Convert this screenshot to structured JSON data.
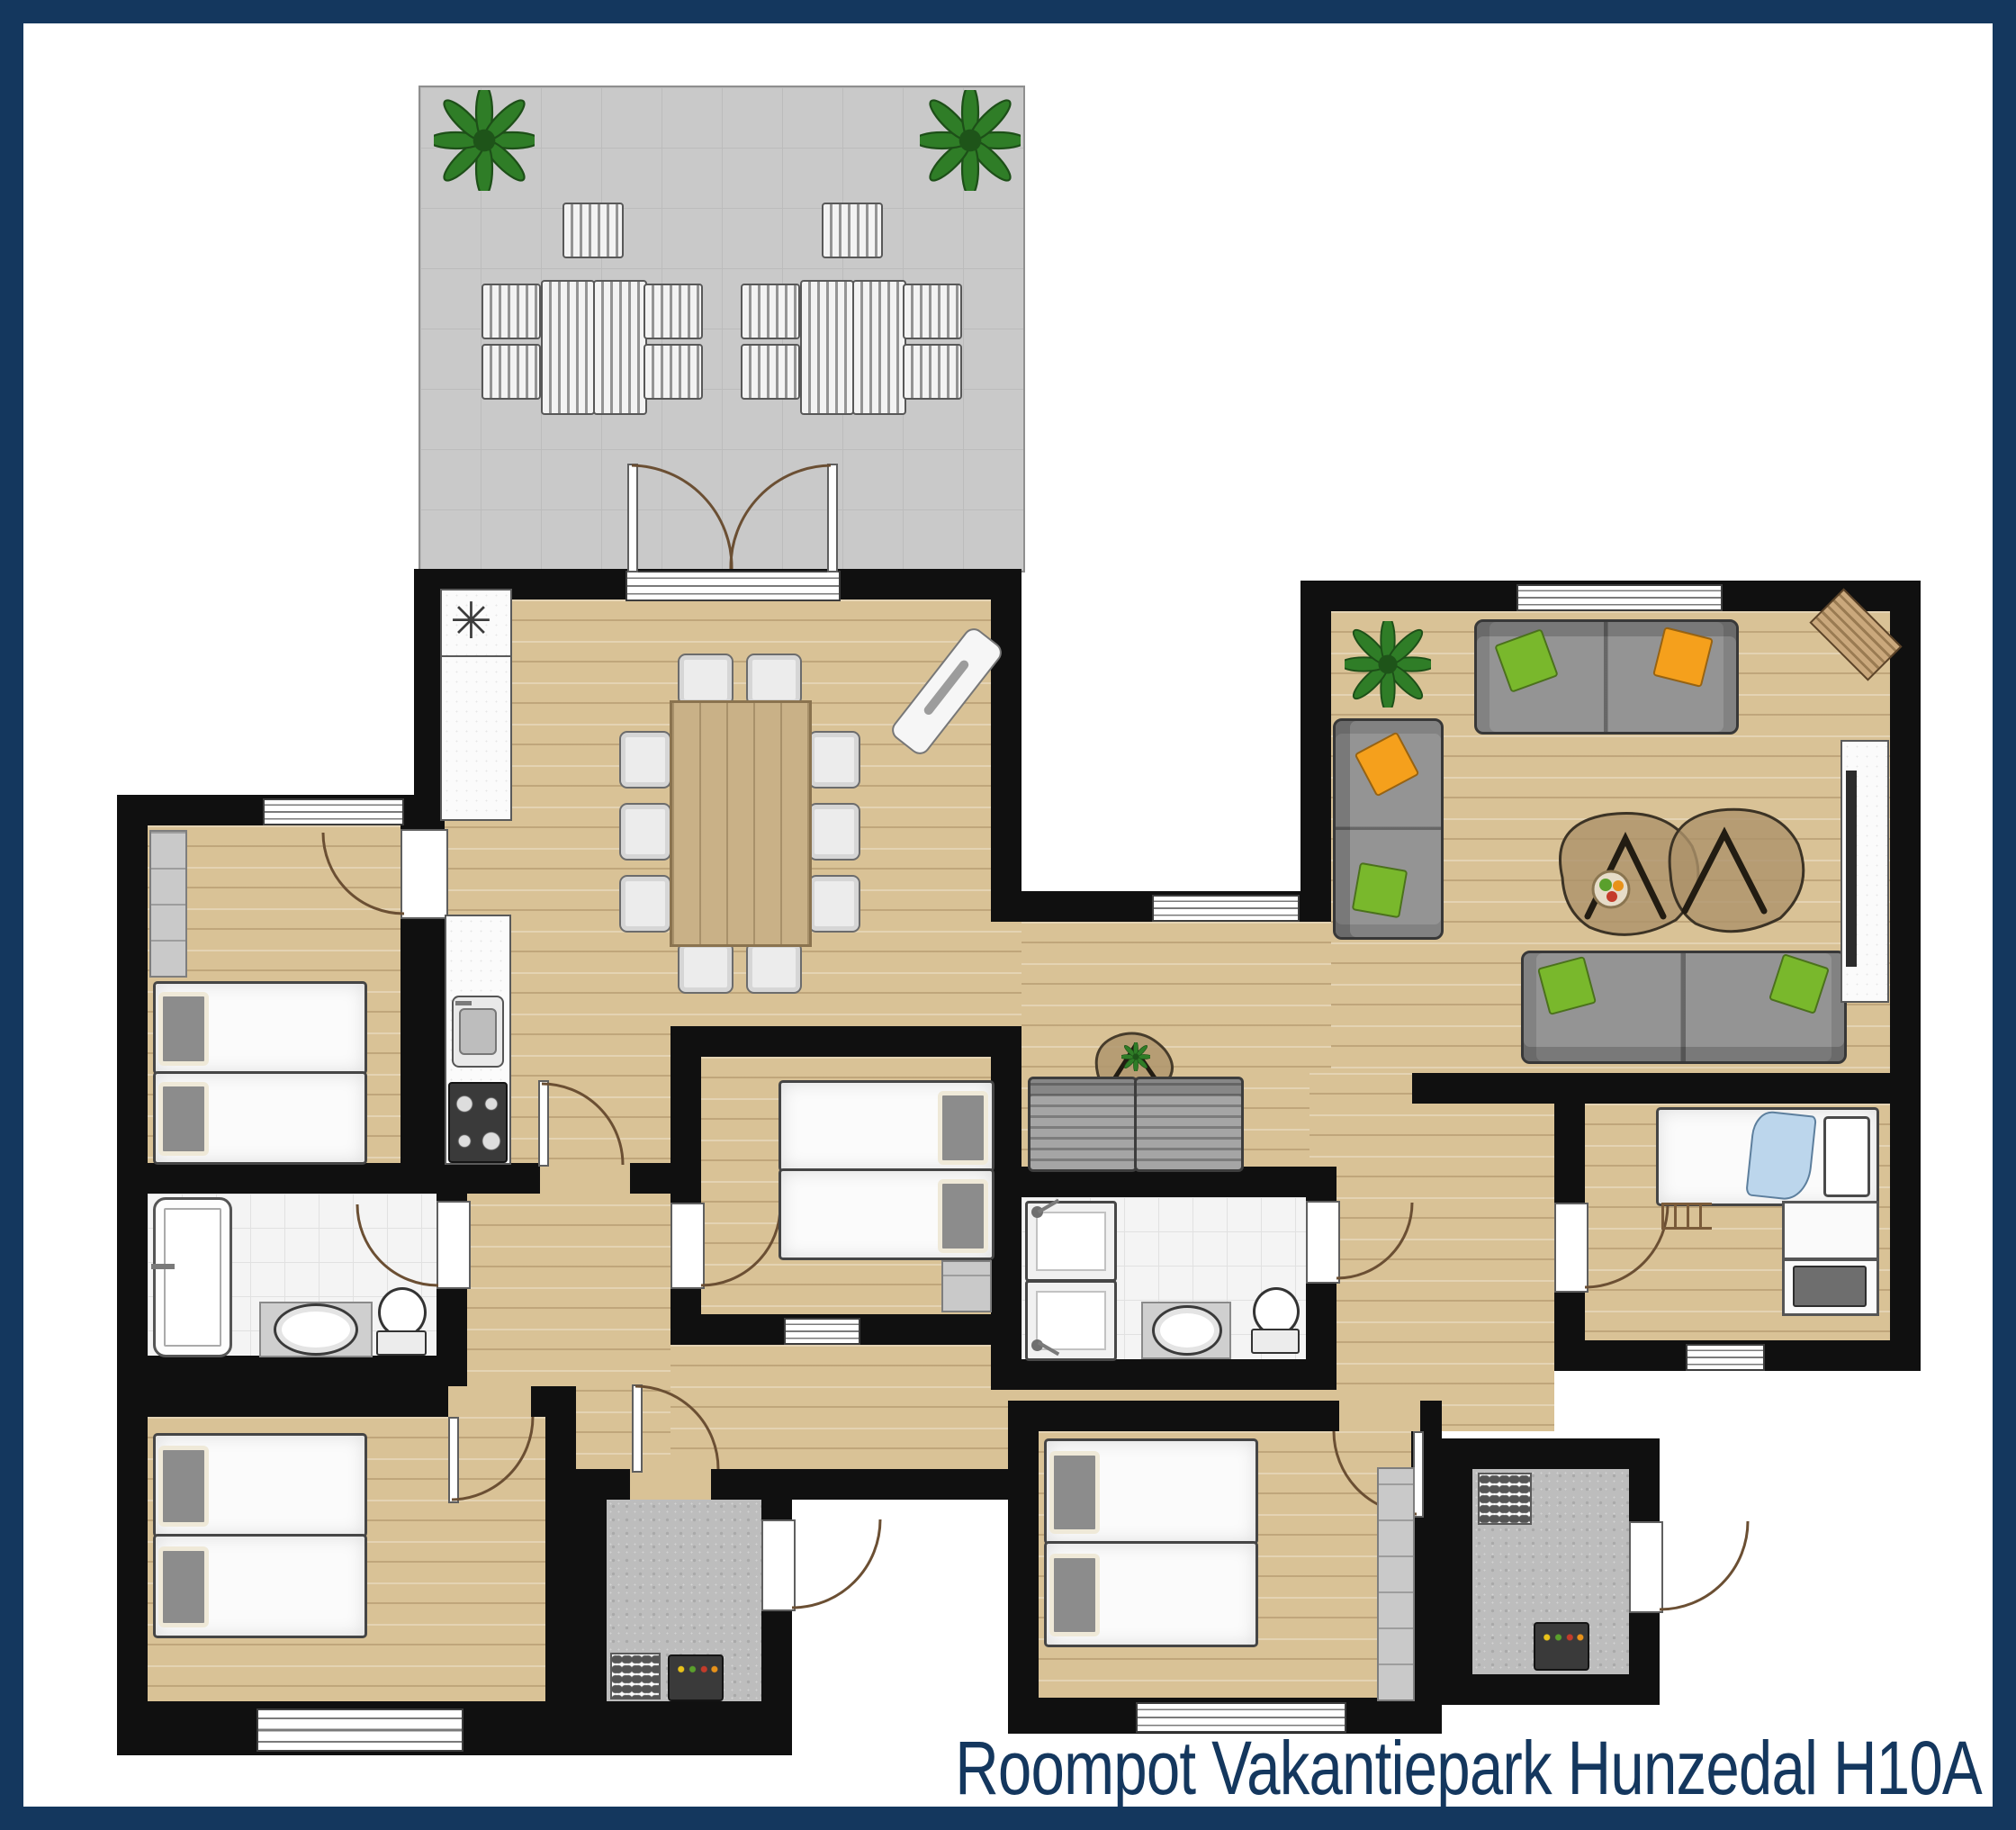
{
  "caption": {
    "text": "Roompot Vakantiepark Hunzedal H10A"
  },
  "symbols": {
    "boiler_asterisk": "✳"
  },
  "palette": {
    "frame_navy": "#14375e",
    "caption_navy": "#14375e",
    "wall_black": "#101010",
    "wood_floor": "#d9c296",
    "tile_white": "#f4f4f4",
    "terrace_gray": "#c9c9c9",
    "storage_gray": "#bdbdbd",
    "sofa_gray": "#949494",
    "pillow_green": "#79b82c",
    "pillow_orange": "#f5a01c",
    "plant_green": "#2f7d27",
    "door_arc_brown": "#6b4f33",
    "bedding_white": "#fbfbfb"
  },
  "rooms": [
    "terrace",
    "kitchen-dining-room",
    "living-room",
    "hallway",
    "bedroom-1",
    "bathroom-1",
    "bedroom-2",
    "storage-room-1",
    "bedroom-3",
    "bathroom-2",
    "bedroom-4",
    "single-bedroom",
    "storage-room-2"
  ],
  "furniture_legend": [
    "garden-lounge-set",
    "potted-plant",
    "dining-table-with-10-chairs",
    "kitchen-counter-sink-stove",
    "boiler-closet",
    "sofa-with-cushions",
    "corner-sofa",
    "coffee-tables",
    "tv-cabinet",
    "double-bed",
    "single-bed",
    "bathtub",
    "double-shower",
    "toilet",
    "washbasin",
    "washing-machine",
    "fuse-panel",
    "wardrobe",
    "hall-bench",
    "side-table-with-plant"
  ]
}
